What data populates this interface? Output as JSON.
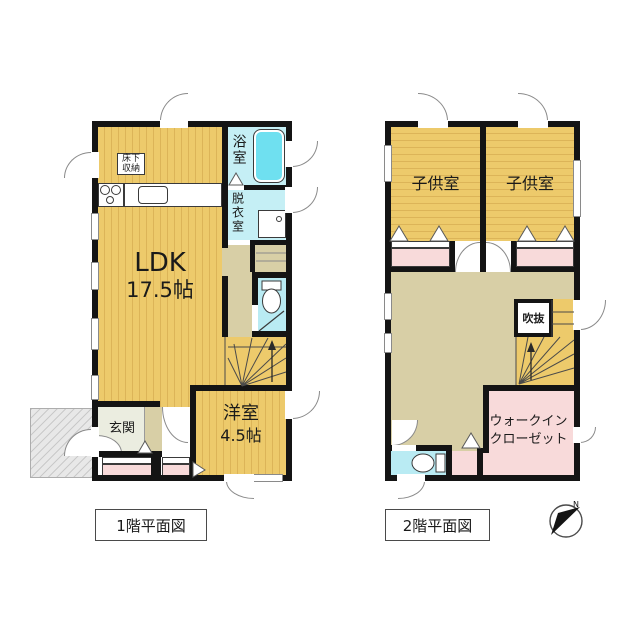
{
  "floor1": {
    "title": "1階平面図",
    "ldk_label": "LDK",
    "ldk_size": "17.5帖",
    "bath_label": "浴室",
    "dressing_label": "脱衣室",
    "underfloor_line1": "床下",
    "underfloor_line2": "収納",
    "western_label": "洋室",
    "western_size": "4.5帖",
    "entrance_label": "玄関"
  },
  "floor2": {
    "title": "2階平面図",
    "kids_left_label": "子供室",
    "kids_right_label": "子供室",
    "void_label": "吹抜",
    "wic_line1": "ウォークイン",
    "wic_line2": "クローゼット"
  },
  "compass": {
    "north_label": "N"
  },
  "colors": {
    "wall": "#141414",
    "wood_floor": "#edca6b",
    "wood_stripe": "#dcb458",
    "hall_floor": "#d8cfa6",
    "wet_floor": "#c5eff5",
    "bathtub": "#6fe0f0",
    "closet_pink": "#f8dada",
    "entrance_floor": "#ebede0",
    "porch_gray": "#e8e8e8"
  }
}
